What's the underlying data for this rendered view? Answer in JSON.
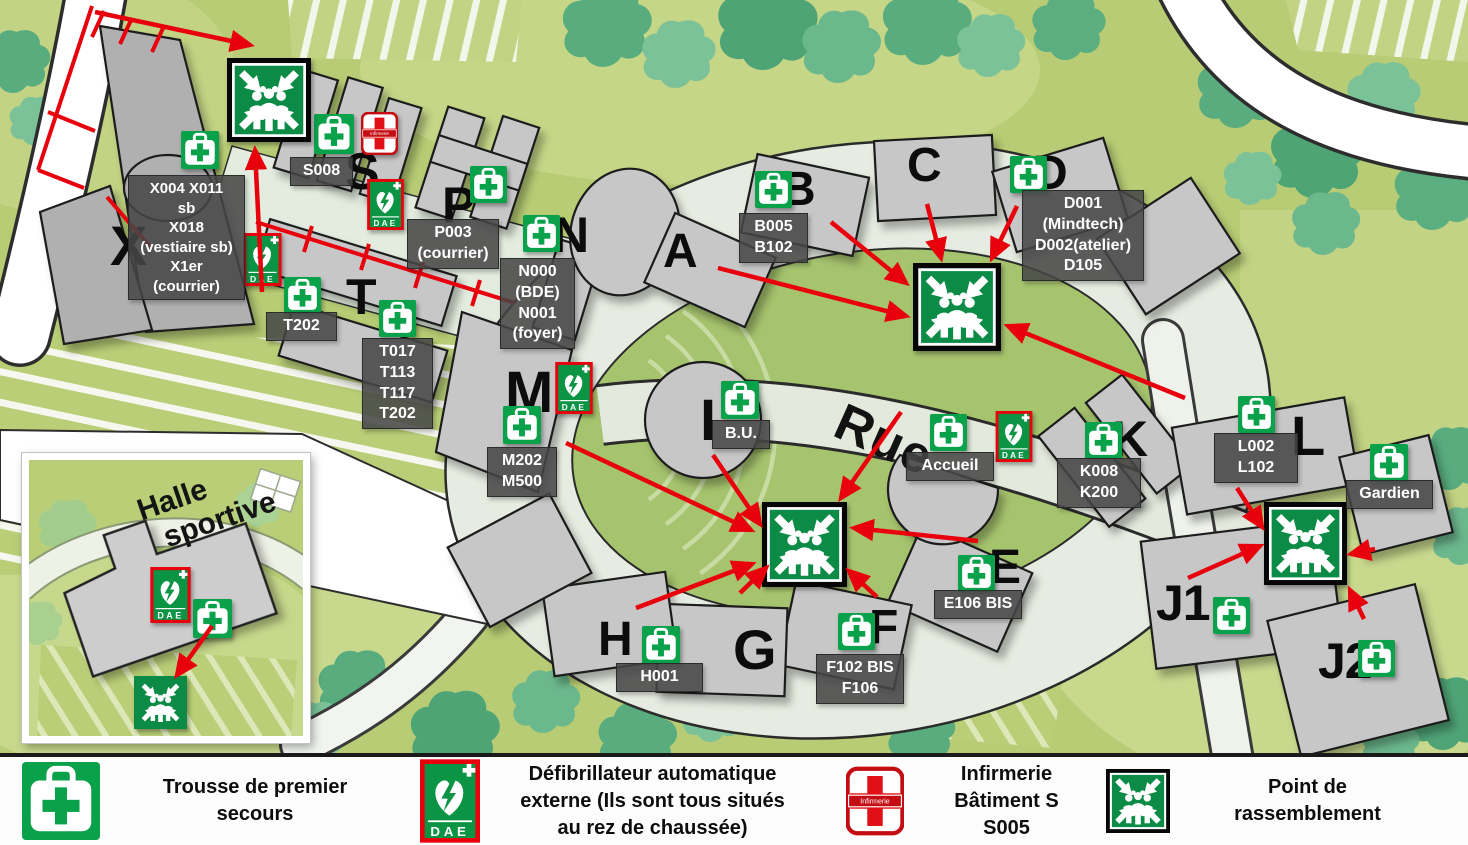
{
  "legend": {
    "items": [
      {
        "icon": "first-aid",
        "lines": [
          "Trousse de premier",
          "secours"
        ]
      },
      {
        "icon": "dae",
        "lines": [
          "Défibrillateur automatique",
          "externe (Ils sont tous situés",
          "au rez de chaussée)"
        ]
      },
      {
        "icon": "infirmerie",
        "lines": [
          "Infirmerie",
          "Bâtiment S",
          "S005"
        ]
      },
      {
        "icon": "assembly",
        "lines": [
          "Point de",
          "rassemblement"
        ]
      }
    ]
  },
  "map": {
    "street_label": "Rue",
    "inset": {
      "line1": "Halle",
      "line2": "sportive"
    },
    "icon_text": {
      "dae": "DAE",
      "infirmerie": "Infirmerie"
    },
    "colors": {
      "accent_red": "#e8000d",
      "safety_green": "#0b8b45",
      "building_gray": "#c7c7c7",
      "lawn_green": "#a6c46e",
      "base_green": "#b7cc74"
    },
    "letters": [
      {
        "text": "X",
        "x": 110,
        "y": 218,
        "fs": 56
      },
      {
        "text": "S",
        "x": 345,
        "y": 146,
        "fs": 52
      },
      {
        "text": "P",
        "x": 442,
        "y": 180,
        "fs": 50
      },
      {
        "text": "N",
        "x": 553,
        "y": 210,
        "fs": 50
      },
      {
        "text": "T",
        "x": 346,
        "y": 272,
        "fs": 50
      },
      {
        "text": "A",
        "x": 663,
        "y": 228,
        "fs": 48
      },
      {
        "text": "B",
        "x": 781,
        "y": 166,
        "fs": 48
      },
      {
        "text": "C",
        "x": 907,
        "y": 142,
        "fs": 48
      },
      {
        "text": "D",
        "x": 1033,
        "y": 150,
        "fs": 48
      },
      {
        "text": "M",
        "x": 505,
        "y": 364,
        "fs": 58
      },
      {
        "text": "I",
        "x": 700,
        "y": 392,
        "fs": 58
      },
      {
        "text": "K",
        "x": 1112,
        "y": 414,
        "fs": 50
      },
      {
        "text": "L",
        "x": 1291,
        "y": 408,
        "fs": 56
      },
      {
        "text": "E",
        "x": 989,
        "y": 544,
        "fs": 48
      },
      {
        "text": "F",
        "x": 869,
        "y": 604,
        "fs": 48
      },
      {
        "text": "G",
        "x": 733,
        "y": 622,
        "fs": 56
      },
      {
        "text": "H",
        "x": 598,
        "y": 616,
        "fs": 48
      },
      {
        "text": "J1",
        "x": 1156,
        "y": 578,
        "fs": 50
      },
      {
        "text": "J2",
        "x": 1318,
        "y": 636,
        "fs": 50
      }
    ],
    "room_labels": [
      {
        "x": 128,
        "y": 175,
        "w": 117,
        "fs": 15,
        "lines": [
          "X004 X011",
          "sb",
          "X018",
          "(vestiaire sb)",
          "X1er",
          "(courrier)"
        ]
      },
      {
        "x": 290,
        "y": 157,
        "w": 63,
        "fs": 16,
        "lines": [
          "S008"
        ]
      },
      {
        "x": 407,
        "y": 219,
        "w": 92,
        "fs": 16,
        "lines": [
          "P003",
          "(courrier)"
        ]
      },
      {
        "x": 500,
        "y": 258,
        "w": 75,
        "fs": 16,
        "lines": [
          "N000",
          "(BDE)",
          "N001",
          "(foyer)"
        ]
      },
      {
        "x": 266,
        "y": 312,
        "w": 71,
        "fs": 16,
        "lines": [
          "T202"
        ]
      },
      {
        "x": 362,
        "y": 338,
        "w": 71,
        "fs": 16,
        "lines": [
          "T017",
          "T113",
          "T117",
          "T202"
        ]
      },
      {
        "x": 487,
        "y": 447,
        "w": 70,
        "fs": 16,
        "lines": [
          "M202",
          "M500"
        ]
      },
      {
        "x": 739,
        "y": 213,
        "w": 69,
        "fs": 16,
        "lines": [
          "B005",
          "B102"
        ]
      },
      {
        "x": 1022,
        "y": 190,
        "w": 122,
        "fs": 16,
        "lines": [
          "D001",
          "(Mindtech)",
          "D002(atelier)",
          "D105"
        ]
      },
      {
        "x": 712,
        "y": 420,
        "w": 58,
        "fs": 16,
        "lines": [
          "B.U."
        ]
      },
      {
        "x": 906,
        "y": 452,
        "w": 88,
        "fs": 16,
        "lines": [
          "Accueil"
        ]
      },
      {
        "x": 1057,
        "y": 458,
        "w": 84,
        "fs": 16,
        "lines": [
          "K008",
          "K200"
        ]
      },
      {
        "x": 1214,
        "y": 433,
        "w": 84,
        "fs": 16,
        "lines": [
          "L002",
          "L102"
        ]
      },
      {
        "x": 1346,
        "y": 480,
        "w": 87,
        "fs": 16,
        "lines": [
          "Gardien"
        ]
      },
      {
        "x": 934,
        "y": 590,
        "w": 88,
        "fs": 16,
        "lines": [
          "E106 BIS"
        ]
      },
      {
        "x": 816,
        "y": 654,
        "w": 88,
        "fs": 16,
        "lines": [
          "F102 BIS",
          "F106"
        ]
      },
      {
        "x": 616,
        "y": 663,
        "w": 87,
        "fs": 16,
        "lines": [
          "H001"
        ]
      }
    ],
    "icons": [
      {
        "t": "first-aid",
        "x": 181,
        "y": 131,
        "s": 38
      },
      {
        "t": "first-aid",
        "x": 314,
        "y": 114,
        "s": 40
      },
      {
        "t": "infirmerie",
        "x": 361,
        "y": 112,
        "w": 37,
        "h": 43
      },
      {
        "t": "dae",
        "x": 367,
        "y": 179,
        "w": 37,
        "h": 51
      },
      {
        "t": "dae",
        "x": 243,
        "y": 233,
        "w": 39,
        "h": 53
      },
      {
        "t": "first-aid",
        "x": 470,
        "y": 166,
        "s": 37
      },
      {
        "t": "first-aid",
        "x": 523,
        "y": 215,
        "s": 37
      },
      {
        "t": "first-aid",
        "x": 284,
        "y": 277,
        "s": 37
      },
      {
        "t": "first-aid",
        "x": 379,
        "y": 300,
        "s": 37
      },
      {
        "t": "dae",
        "x": 555,
        "y": 362,
        "w": 38,
        "h": 52
      },
      {
        "t": "first-aid",
        "x": 503,
        "y": 406,
        "s": 38
      },
      {
        "t": "first-aid",
        "x": 755,
        "y": 171,
        "s": 37
      },
      {
        "t": "first-aid",
        "x": 1010,
        "y": 156,
        "s": 37
      },
      {
        "t": "first-aid",
        "x": 721,
        "y": 381,
        "s": 38
      },
      {
        "t": "first-aid",
        "x": 930,
        "y": 414,
        "s": 37
      },
      {
        "t": "dae",
        "x": 995,
        "y": 411,
        "w": 38,
        "h": 51
      },
      {
        "t": "first-aid",
        "x": 1085,
        "y": 422,
        "s": 37
      },
      {
        "t": "first-aid",
        "x": 1238,
        "y": 396,
        "s": 37
      },
      {
        "t": "first-aid",
        "x": 1370,
        "y": 444,
        "s": 38
      },
      {
        "t": "first-aid",
        "x": 958,
        "y": 555,
        "s": 37
      },
      {
        "t": "first-aid",
        "x": 838,
        "y": 613,
        "s": 37
      },
      {
        "t": "first-aid",
        "x": 642,
        "y": 626,
        "s": 38
      },
      {
        "t": "first-aid",
        "x": 1213,
        "y": 597,
        "s": 37
      },
      {
        "t": "first-aid",
        "x": 1358,
        "y": 640,
        "s": 37
      },
      {
        "t": "assembly",
        "x": 227,
        "y": 58,
        "s": 84
      },
      {
        "t": "assembly",
        "x": 913,
        "y": 263,
        "s": 88
      },
      {
        "t": "assembly",
        "x": 762,
        "y": 502,
        "s": 85
      },
      {
        "t": "assembly",
        "x": 1264,
        "y": 502,
        "s": 83
      },
      {
        "t": "dae",
        "x": 150,
        "y": 567,
        "w": 41,
        "h": 56
      },
      {
        "t": "first-aid",
        "x": 193,
        "y": 599,
        "s": 39
      },
      {
        "t": "assembly-plain",
        "x": 134,
        "y": 676,
        "s": 53
      }
    ],
    "arrows": [
      [
        831,
        222,
        906,
        283
      ],
      [
        927,
        204,
        941,
        258
      ],
      [
        1017,
        206,
        992,
        258
      ],
      [
        718,
        268,
        906,
        316
      ],
      [
        1185,
        398,
        1008,
        326
      ],
      [
        713,
        455,
        760,
        524
      ],
      [
        901,
        412,
        841,
        498
      ],
      [
        566,
        443,
        751,
        530
      ],
      [
        636,
        608,
        752,
        564
      ],
      [
        740,
        593,
        766,
        568
      ],
      [
        877,
        597,
        849,
        571
      ],
      [
        978,
        541,
        854,
        528
      ],
      [
        1237,
        488,
        1262,
        527
      ],
      [
        1188,
        578,
        1260,
        546
      ],
      [
        1375,
        549,
        1351,
        554
      ],
      [
        1364,
        619,
        1350,
        590
      ],
      [
        95,
        12,
        250,
        45
      ],
      [
        262,
        292,
        255,
        150
      ],
      [
        212,
        626,
        177,
        675
      ]
    ],
    "red_lines": [
      [
        92,
        6,
        38,
        170
      ],
      [
        38,
        170,
        84,
        188
      ],
      [
        104,
        11,
        92,
        37
      ],
      [
        132,
        18,
        120,
        44
      ],
      [
        164,
        26,
        152,
        52
      ],
      [
        48,
        112,
        95,
        131
      ],
      [
        107,
        197,
        152,
        249
      ],
      [
        256,
        222,
        515,
        303
      ],
      [
        312,
        226,
        304,
        252
      ],
      [
        369,
        244,
        361,
        270
      ],
      [
        423,
        262,
        415,
        288
      ],
      [
        480,
        280,
        472,
        306
      ]
    ]
  }
}
